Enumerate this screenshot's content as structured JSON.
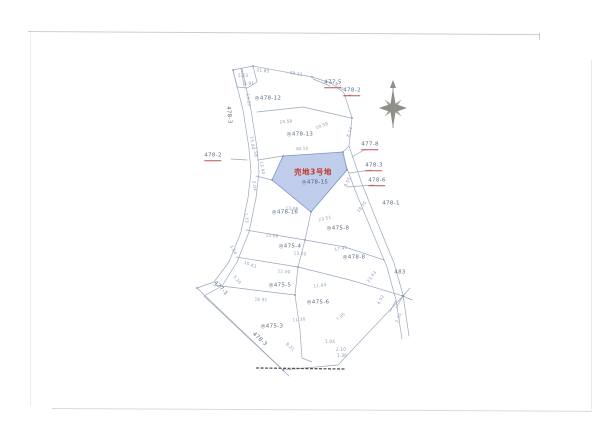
{
  "map": {
    "title_parcel": {
      "sale_label": "売地3号地",
      "sale_parcel_number": "◎478-15"
    },
    "colors": {
      "boundary_line": "#9aa8bd",
      "parcel_label": "#5d6c86",
      "red_accent": "#c25252",
      "sale_text": "#c0392b",
      "highlight_fill": "#b9c9ea",
      "highlight_stroke": "#7b93c4",
      "compass": "#8d9086",
      "scan_border": "#bdbdbd",
      "fold_line": "#555555"
    },
    "compass": {
      "name": "north-compass",
      "direction": "N"
    },
    "texts": [
      {
        "t": "売地3号地",
        "x": 313,
        "y": 172,
        "k": "sale"
      },
      {
        "t": "◎478-15",
        "x": 315,
        "y": 183,
        "k": "salenum"
      },
      {
        "t": "477-5",
        "x": 333,
        "y": 84,
        "k": "label",
        "u": 1
      },
      {
        "t": "478-2",
        "x": 352,
        "y": 92,
        "k": "label",
        "u": 1
      },
      {
        "t": "◎478-12",
        "x": 268,
        "y": 99,
        "k": "label"
      },
      {
        "t": "◎478-13",
        "x": 300,
        "y": 135,
        "k": "label"
      },
      {
        "t": "478-2",
        "x": 213,
        "y": 157,
        "k": "label",
        "u": 1
      },
      {
        "t": "477-8",
        "x": 370,
        "y": 146,
        "k": "label",
        "u": 1
      },
      {
        "t": "478-3",
        "x": 374,
        "y": 167,
        "k": "label",
        "u": 1
      },
      {
        "t": "478-6",
        "x": 377,
        "y": 182,
        "k": "label",
        "u": 1
      },
      {
        "t": "478-1",
        "x": 391,
        "y": 204,
        "k": "label"
      },
      {
        "t": "◎478-16",
        "x": 285,
        "y": 213,
        "k": "label"
      },
      {
        "t": "◎475-8",
        "x": 338,
        "y": 229,
        "k": "label"
      },
      {
        "t": "◎475-4",
        "x": 290,
        "y": 247,
        "k": "label"
      },
      {
        "t": "◎478-8",
        "x": 354,
        "y": 258,
        "k": "label"
      },
      {
        "t": "483",
        "x": 400,
        "y": 273,
        "k": "label"
      },
      {
        "t": "◎475-5",
        "x": 280,
        "y": 286,
        "k": "label"
      },
      {
        "t": "◎475-6",
        "x": 318,
        "y": 303,
        "k": "label"
      },
      {
        "t": "◎475-3",
        "x": 272,
        "y": 327,
        "k": "label"
      },
      {
        "t": "478-3",
        "x": 259,
        "y": 340,
        "k": "label",
        "r": 43
      },
      {
        "t": "478-3",
        "x": 228,
        "y": 115,
        "k": "label",
        "r": 84
      },
      {
        "t": "477-1",
        "x": 220,
        "y": 289,
        "k": "label",
        "r": 46
      },
      {
        "t": "21.85",
        "x": 263,
        "y": 71,
        "k": "meas",
        "r": 7
      },
      {
        "t": "29.12",
        "x": 296,
        "y": 74,
        "k": "meas",
        "r": 9
      },
      {
        "t": "5.23",
        "x": 243,
        "y": 76,
        "k": "meas"
      },
      {
        "t": "3.91",
        "x": 249,
        "y": 84,
        "k": "meas"
      },
      {
        "t": "4.29",
        "x": 339,
        "y": 87,
        "k": "meas",
        "r": 40
      },
      {
        "t": "13.57",
        "x": 248,
        "y": 100,
        "k": "meas",
        "r": 84
      },
      {
        "t": "24.58",
        "x": 286,
        "y": 122,
        "k": "meas",
        "r": -4
      },
      {
        "t": "19.58",
        "x": 322,
        "y": 126,
        "k": "meas",
        "r": -20
      },
      {
        "t": "6.14",
        "x": 350,
        "y": 132,
        "k": "meas",
        "r": -70
      },
      {
        "t": "15.04",
        "x": 252,
        "y": 143,
        "k": "meas",
        "r": 84
      },
      {
        "t": "38.10",
        "x": 302,
        "y": 149,
        "k": "meas",
        "r": -3
      },
      {
        "t": "1.58",
        "x": 255,
        "y": 152,
        "k": "meas",
        "r": 84
      },
      {
        "t": "12.40",
        "x": 262,
        "y": 168,
        "k": "meas",
        "r": 80
      },
      {
        "t": "8.55",
        "x": 348,
        "y": 182,
        "k": "meas",
        "r": -65
      },
      {
        "t": "2.04",
        "x": 254,
        "y": 186,
        "k": "meas",
        "r": 84
      },
      {
        "t": "13.08",
        "x": 292,
        "y": 209,
        "k": "meas",
        "r": 4
      },
      {
        "t": "23.51",
        "x": 325,
        "y": 219,
        "k": "meas",
        "r": -14
      },
      {
        "t": "18.35",
        "x": 362,
        "y": 207,
        "k": "meas",
        "r": -52
      },
      {
        "t": "1.73",
        "x": 246,
        "y": 218,
        "k": "meas",
        "r": 84
      },
      {
        "t": "15.08",
        "x": 272,
        "y": 236,
        "k": "meas",
        "r": 5
      },
      {
        "t": "17.45",
        "x": 341,
        "y": 249,
        "k": "meas",
        "r": -10
      },
      {
        "t": "3.04",
        "x": 233,
        "y": 250,
        "k": "meas",
        "r": 60
      },
      {
        "t": "13.00",
        "x": 300,
        "y": 254,
        "k": "meas",
        "r": 5
      },
      {
        "t": "10.43",
        "x": 250,
        "y": 265,
        "k": "meas",
        "r": 20
      },
      {
        "t": "12.00",
        "x": 284,
        "y": 272,
        "k": "meas",
        "r": 4
      },
      {
        "t": "23.43",
        "x": 372,
        "y": 277,
        "k": "meas",
        "r": -55
      },
      {
        "t": "5.16",
        "x": 237,
        "y": 280,
        "k": "meas",
        "r": 48
      },
      {
        "t": "11.04",
        "x": 320,
        "y": 286,
        "k": "meas",
        "r": -8
      },
      {
        "t": "16.91",
        "x": 261,
        "y": 300,
        "k": "meas",
        "r": 4
      },
      {
        "t": "4.52",
        "x": 381,
        "y": 300,
        "k": "meas",
        "r": -62
      },
      {
        "t": "2.31",
        "x": 399,
        "y": 318,
        "k": "meas",
        "r": -68
      },
      {
        "t": "11.30",
        "x": 299,
        "y": 320,
        "k": "meas",
        "r": -5
      },
      {
        "t": "7.05",
        "x": 341,
        "y": 317,
        "k": "meas",
        "r": -42
      },
      {
        "t": "1.04",
        "x": 330,
        "y": 342,
        "k": "meas"
      },
      {
        "t": "8.21",
        "x": 290,
        "y": 347,
        "k": "meas",
        "r": 43
      },
      {
        "t": "2.10",
        "x": 341,
        "y": 350,
        "k": "meas"
      },
      {
        "t": "1.36",
        "x": 342,
        "y": 356,
        "k": "meas"
      }
    ]
  }
}
